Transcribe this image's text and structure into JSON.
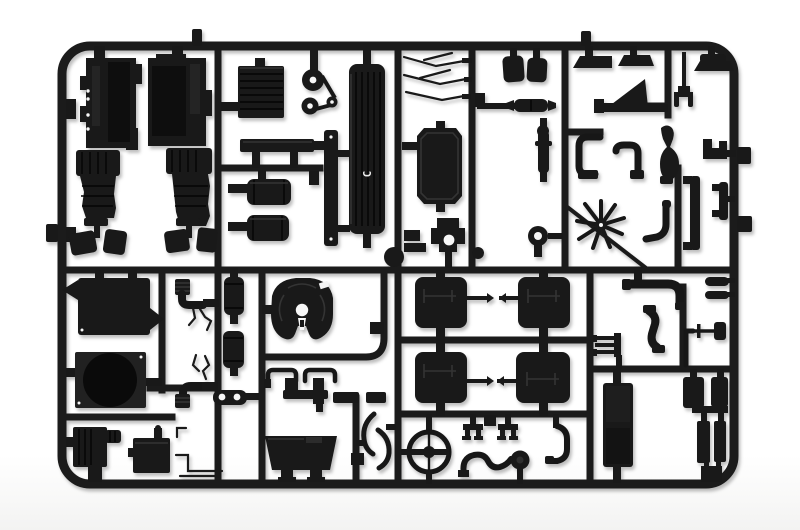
{
  "photo": {
    "subject": "black injection-molded model kit sprue with truck parts",
    "background_color": "#ffffff",
    "plastic_color": "#191919",
    "sprue_marking": "C"
  },
  "parts": [
    "engine-block-half-left",
    "engine-block-half-right",
    "transmission-flaps",
    "radiator-core",
    "pulley-belt-assembly",
    "chassis-crossmember",
    "air-filter-canisters",
    "mounting-strip",
    "slatted-panel-marked-c",
    "runner-ball",
    "wiper-arms",
    "engine-cover-panel",
    "mount-bracket-with-hole",
    "seat-cushions",
    "muffler",
    "shock-absorber",
    "towing-ring",
    "mud-flaps",
    "roof-deflector-fin",
    "steering-fork",
    "exhaust-elbow-pipes",
    "gear-lever-boot",
    "radiator-fan",
    "fan-j-pipe",
    "side-channel-brackets",
    "cab-roof-panel",
    "fan-shroud-ring",
    "battery-box",
    "electrical-box",
    "corrugated-intake-hoses",
    "air-reservoir-tanks",
    "twin-hole-plate",
    "fifth-wheel-coupling",
    "brake-valve-assembly",
    "fuel-tank-saddle",
    "curved-hand-rails",
    "cab-suspension-panels",
    "steering-wheel",
    "line-clips",
    "exhaust-pipe-with-turbocharger",
    "j-shaped-pipe",
    "air-pipe-elbow-large",
    "exhaust-s-pipe",
    "trident-bracket",
    "drain-valve",
    "step-pads",
    "door-step-panel",
    "chassis-pads",
    "chassis-bars",
    "brake-lines",
    "sprue-frame"
  ]
}
